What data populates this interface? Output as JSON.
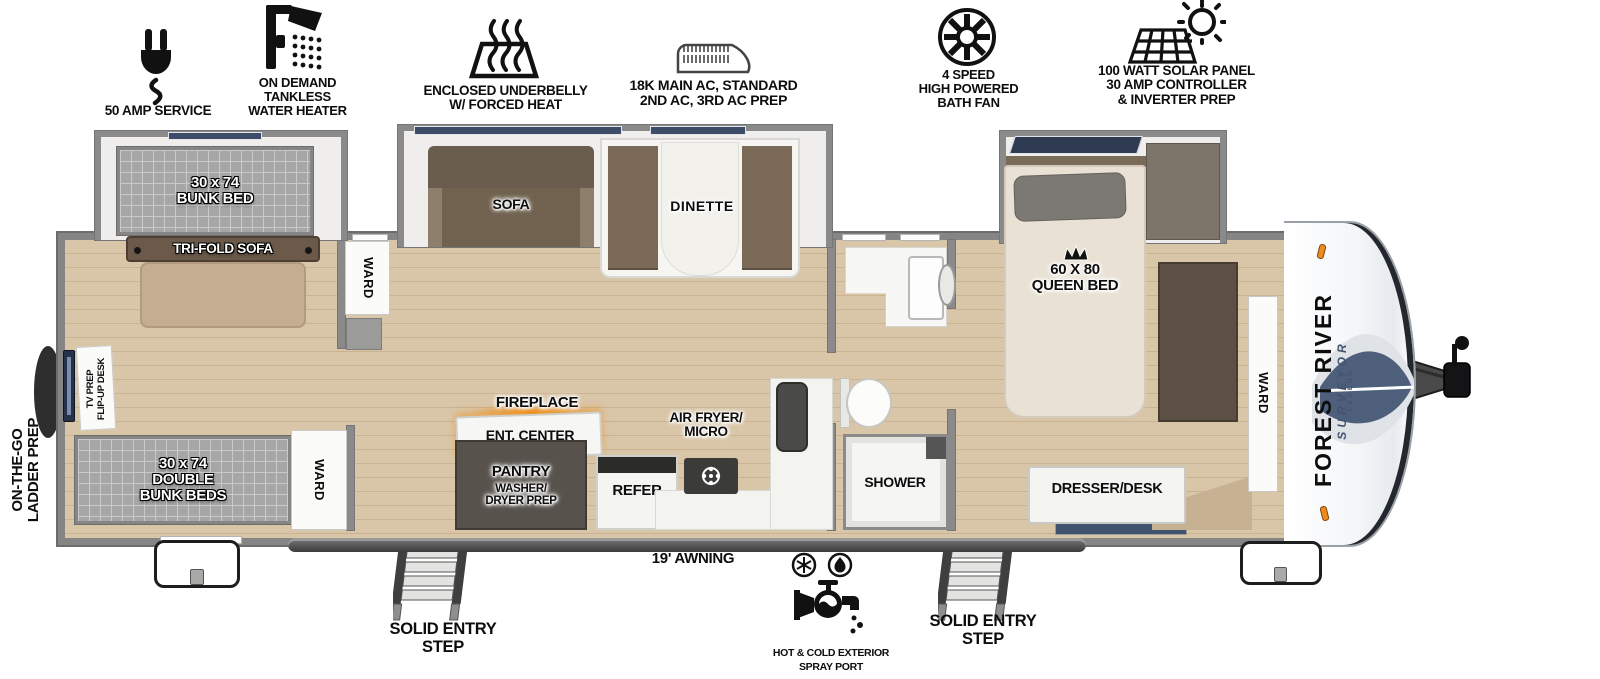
{
  "title": "Travel trailer floorplan",
  "features": [
    {
      "icon": "power-plug-icon",
      "label": "50 AMP SERVICE"
    },
    {
      "icon": "shower-head-icon",
      "label": "ON DEMAND\nTANKLESS\nWATER HEATER"
    },
    {
      "icon": "underbelly-heat-icon",
      "label": "ENCLOSED UNDERBELLY\nW/ FORCED HEAT"
    },
    {
      "icon": "ac-unit-icon",
      "label": "18K MAIN AC, STANDARD\n2ND AC, 3RD AC PREP"
    },
    {
      "icon": "bath-fan-icon",
      "label": "4 SPEED\nHIGH POWERED\nBATH FAN"
    },
    {
      "icon": "solar-panel-icon",
      "label": "100 WATT SOLAR PANEL\n30 AMP CONTROLLER\n& INVERTER PREP"
    }
  ],
  "fp": {
    "bunk_bed": "30 x 74\nBUNK BED",
    "tri_fold_sofa": "TRI-FOLD SOFA",
    "tv_prep": "TV PREP\nFLIP-UP DESK",
    "double_bunk": "30 x 74\nDOUBLE\nBUNK BEDS",
    "ward": "WARD",
    "sofa": "SOFA",
    "dinette": "DINETTE",
    "fireplace": "FIREPLACE",
    "ent_center": "ENT. CENTER",
    "pantry": "PANTRY",
    "pantry_sub": "WASHER/\nDRYER PREP",
    "refer": "REFER",
    "air_fryer": "AIR FRYER/\nMICRO",
    "shower": "SHOWER",
    "queen_bed": "60 X 80\nQUEEN BED",
    "dresser": "DRESSER/DESK"
  },
  "ext": {
    "ladder_prep": "ON-THE-GO\nLADDER PREP",
    "awning": "19' AWNING",
    "entry_step": "SOLID ENTRY\nSTEP",
    "spray_port": "HOT & COLD EXTERIOR\nSPRAY PORT",
    "brand": "FOREST RIVER",
    "model": "SURVEYOR",
    "trim": "LEGEND"
  },
  "colors": {
    "wall": "#8a8a8a",
    "floor": "#d9c6a8",
    "plank_line": "#cab293",
    "window": "#3d4c68",
    "sofa_brown": "#6a5d4e",
    "bench_brown": "#7b6a58",
    "marker_light": "#ef8a1c",
    "fire_glow": "#f08c14",
    "brand_navy": "#44546e"
  }
}
